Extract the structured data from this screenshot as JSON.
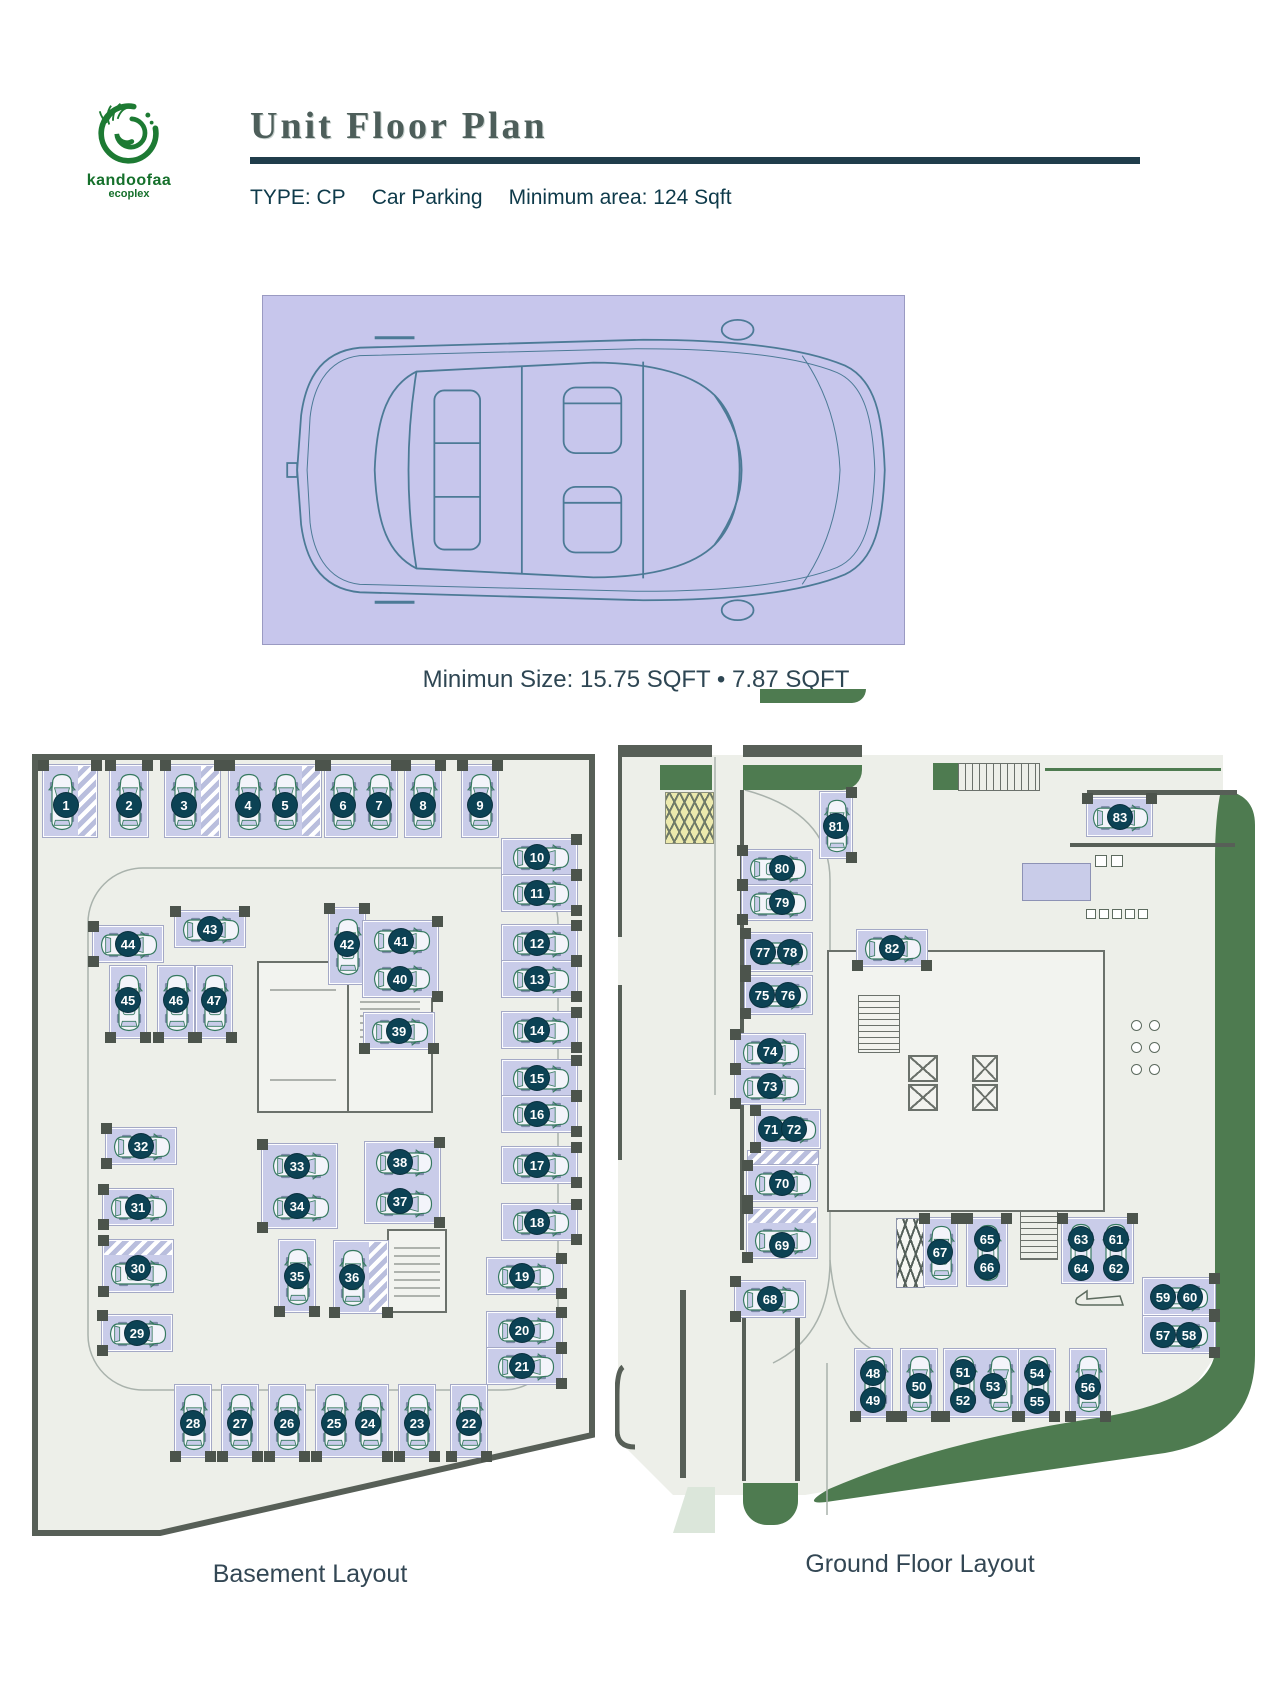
{
  "header": {
    "brand": "kandoofaa",
    "brand_sub": "ecoplex",
    "title": "Unit Floor Plan",
    "type_label": "TYPE: CP",
    "type_name": "Car Parking",
    "min_area": "Minimum area: 124 Sqft"
  },
  "spec": {
    "caption": "Minimun Size: 15.75 SQFT • 7.87 SQFT"
  },
  "colors": {
    "floor": "#edefe9",
    "wall": "#575f57",
    "stall": "#c9cce9",
    "circle": "#0c4254",
    "green": "#4e7b50",
    "logo-green": "#1d7a33",
    "rule": "#203d4b",
    "car-line": "#35795f",
    "spec-bg": "#c7c6ec",
    "yellow": "#ece9ad"
  },
  "plans": [
    {
      "id": "basement",
      "label": "Basement Layout",
      "outline": "5,57 562,57 562,735 130,833 5,833",
      "stalls": [
        {
          "x": 13,
          "y": 65,
          "w": 54,
          "h": 72,
          "dir": "v",
          "a": "t",
          "hatch": "r",
          "c": [
            [
              "1",
              36,
              105
            ]
          ]
        },
        {
          "x": 80,
          "y": 65,
          "w": 38,
          "h": 72,
          "dir": "v",
          "a": "t",
          "c": [
            [
              "2",
              99,
              105
            ]
          ]
        },
        {
          "x": 135,
          "y": 65,
          "w": 55,
          "h": 72,
          "dir": "v",
          "a": "t",
          "hatch": "r",
          "c": [
            [
              "3",
              154,
              105
            ]
          ]
        },
        {
          "x": 199,
          "y": 65,
          "w": 92,
          "h": 72,
          "dir": "v",
          "a": "t",
          "hatch": "r",
          "c": [
            [
              "4",
              218,
              105
            ],
            [
              "5",
              255,
              105
            ]
          ]
        },
        {
          "x": 295,
          "y": 65,
          "w": 72,
          "h": 72,
          "dir": "v",
          "a": "t",
          "c": [
            [
              "6",
              313,
              105
            ],
            [
              "7",
              349,
              105
            ]
          ]
        },
        {
          "x": 375,
          "y": 65,
          "w": 36,
          "h": 72,
          "dir": "v",
          "a": "t",
          "c": [
            [
              "8",
              393,
              105
            ]
          ]
        },
        {
          "x": 432,
          "y": 65,
          "w": 36,
          "h": 72,
          "dir": "v",
          "a": "t",
          "c": [
            [
              "9",
              450,
              105
            ]
          ]
        },
        {
          "x": 472,
          "y": 139,
          "w": 75,
          "h": 36,
          "dir": "h",
          "a": "r",
          "c": [
            [
              "10",
              507,
              157
            ]
          ]
        },
        {
          "x": 472,
          "y": 175,
          "w": 75,
          "h": 36,
          "dir": "h",
          "a": "r",
          "c": [
            [
              "11",
              507,
              193
            ]
          ]
        },
        {
          "x": 472,
          "y": 225,
          "w": 75,
          "h": 36,
          "dir": "h",
          "a": "r",
          "c": [
            [
              "12",
              507,
              243
            ]
          ]
        },
        {
          "x": 472,
          "y": 261,
          "w": 75,
          "h": 36,
          "dir": "h",
          "a": "r",
          "c": [
            [
              "13",
              507,
              279
            ]
          ]
        },
        {
          "x": 472,
          "y": 312,
          "w": 75,
          "h": 36,
          "dir": "h",
          "a": "r",
          "c": [
            [
              "14",
              507,
              330
            ]
          ]
        },
        {
          "x": 472,
          "y": 360,
          "w": 75,
          "h": 36,
          "dir": "h",
          "a": "r",
          "c": [
            [
              "15",
              507,
              378
            ]
          ]
        },
        {
          "x": 472,
          "y": 396,
          "w": 75,
          "h": 36,
          "dir": "h",
          "a": "r",
          "c": [
            [
              "16",
              507,
              414
            ]
          ]
        },
        {
          "x": 472,
          "y": 447,
          "w": 75,
          "h": 36,
          "dir": "h",
          "a": "r",
          "c": [
            [
              "17",
              507,
              465
            ]
          ]
        },
        {
          "x": 472,
          "y": 504,
          "w": 75,
          "h": 36,
          "dir": "h",
          "a": "r",
          "c": [
            [
              "18",
              507,
              522
            ]
          ]
        },
        {
          "x": 457,
          "y": 558,
          "w": 75,
          "h": 36,
          "dir": "h",
          "a": "r",
          "c": [
            [
              "19",
              492,
              576
            ]
          ]
        },
        {
          "x": 457,
          "y": 612,
          "w": 75,
          "h": 36,
          "dir": "h",
          "a": "r",
          "c": [
            [
              "20",
              492,
              630
            ]
          ]
        },
        {
          "x": 457,
          "y": 648,
          "w": 75,
          "h": 36,
          "dir": "h",
          "a": "r",
          "c": [
            [
              "21",
              492,
              666
            ]
          ]
        },
        {
          "x": 421,
          "y": 685,
          "w": 36,
          "h": 72,
          "dir": "v",
          "a": "b",
          "c": [
            [
              "22",
              439,
              723
            ]
          ]
        },
        {
          "x": 369,
          "y": 685,
          "w": 36,
          "h": 72,
          "dir": "v",
          "a": "b",
          "c": [
            [
              "23",
              387,
              723
            ]
          ]
        },
        {
          "x": 286,
          "y": 685,
          "w": 72,
          "h": 72,
          "dir": "v",
          "a": "b",
          "c": [
            [
              "25",
              304,
              723
            ],
            [
              "24",
              338,
              723
            ]
          ]
        },
        {
          "x": 239,
          "y": 685,
          "w": 36,
          "h": 72,
          "dir": "v",
          "a": "b",
          "c": [
            [
              "26",
              257,
              723
            ]
          ]
        },
        {
          "x": 192,
          "y": 685,
          "w": 36,
          "h": 72,
          "dir": "v",
          "a": "b",
          "c": [
            [
              "27",
              210,
              723
            ]
          ]
        },
        {
          "x": 145,
          "y": 685,
          "w": 36,
          "h": 72,
          "dir": "v",
          "a": "b",
          "c": [
            [
              "28",
              163,
              723
            ]
          ]
        },
        {
          "x": 72,
          "y": 615,
          "w": 70,
          "h": 36,
          "dir": "h",
          "a": "l",
          "c": [
            [
              "29",
              107,
              633
            ]
          ]
        },
        {
          "x": 73,
          "y": 540,
          "w": 70,
          "h": 52,
          "dir": "h",
          "a": "l",
          "hatch": "t",
          "c": [
            [
              "30",
              108,
              568
            ]
          ]
        },
        {
          "x": 73,
          "y": 489,
          "w": 70,
          "h": 36,
          "dir": "h",
          "a": "l",
          "c": [
            [
              "31",
              108,
              507
            ]
          ]
        },
        {
          "x": 76,
          "y": 428,
          "w": 70,
          "h": 36,
          "dir": "h",
          "a": "l",
          "c": [
            [
              "32",
              111,
              446
            ]
          ]
        },
        {
          "x": 63,
          "y": 226,
          "w": 70,
          "h": 36,
          "dir": "h",
          "a": "l",
          "c": [
            [
              "44",
              98,
              244
            ]
          ]
        },
        {
          "x": 145,
          "y": 211,
          "w": 70,
          "h": 36,
          "dir": "h",
          "a": "t",
          "c": [
            [
              "43",
              180,
              229
            ]
          ]
        },
        {
          "x": 80,
          "y": 266,
          "w": 36,
          "h": 72,
          "dir": "v",
          "a": "b",
          "c": [
            [
              "45",
              98,
              300
            ]
          ]
        },
        {
          "x": 128,
          "y": 266,
          "w": 36,
          "h": 72,
          "dir": "v",
          "a": "b",
          "c": [
            [
              "46",
              146,
              300
            ]
          ]
        },
        {
          "x": 166,
          "y": 266,
          "w": 36,
          "h": 72,
          "dir": "v",
          "a": "b",
          "c": [
            [
              "47",
              184,
              300
            ]
          ]
        },
        {
          "x": 299,
          "y": 208,
          "w": 36,
          "h": 76,
          "dir": "v",
          "a": "t",
          "c": [
            [
              "42",
              317,
              244
            ]
          ]
        },
        {
          "x": 333,
          "y": 221,
          "w": 75,
          "h": 76,
          "dir": "h",
          "a": "r",
          "c": [
            [
              "41",
              371,
              241
            ],
            [
              "40",
              370,
              279
            ]
          ]
        },
        {
          "x": 334,
          "y": 313,
          "w": 70,
          "h": 36,
          "dir": "h",
          "a": "b",
          "c": [
            [
              "39",
              369,
              331
            ]
          ]
        },
        {
          "x": 232,
          "y": 444,
          "w": 75,
          "h": 84,
          "dir": "h",
          "a": "l",
          "c": [
            [
              "33",
              267,
              466
            ],
            [
              "34",
              267,
              506
            ]
          ]
        },
        {
          "x": 335,
          "y": 442,
          "w": 75,
          "h": 81,
          "dir": "h",
          "a": "r",
          "c": [
            [
              "38",
              370,
              462
            ],
            [
              "37",
              370,
              501
            ]
          ]
        },
        {
          "x": 249,
          "y": 540,
          "w": 36,
          "h": 72,
          "dir": "v",
          "a": "b",
          "c": [
            [
              "35",
              267,
              576
            ]
          ]
        },
        {
          "x": 304,
          "y": 541,
          "w": 54,
          "h": 72,
          "dir": "v",
          "a": "b",
          "hatch": "r",
          "c": [
            [
              "36",
              322,
              577
            ]
          ]
        }
      ]
    },
    {
      "id": "ground",
      "label": "Ground Floor Layout",
      "stalls": [
        {
          "x": 205,
          "y": 97,
          "w": 32,
          "h": 66,
          "dir": "v",
          "a": "r",
          "c": [
            [
              "81",
              221,
              131
            ]
          ]
        },
        {
          "x": 127,
          "y": 155,
          "w": 70,
          "h": 35,
          "dir": "h",
          "a": "l",
          "c": [
            [
              "80",
              167,
              173
            ]
          ]
        },
        {
          "x": 127,
          "y": 190,
          "w": 70,
          "h": 35,
          "dir": "h",
          "a": "l",
          "c": [
            [
              "79",
              167,
              207
            ]
          ]
        },
        {
          "x": 130,
          "y": 238,
          "w": 67,
          "h": 38,
          "dir": "h",
          "a": "l",
          "c": [
            [
              "77",
              148,
              257
            ],
            [
              "78",
              175,
              257
            ]
          ]
        },
        {
          "x": 130,
          "y": 281,
          "w": 67,
          "h": 38,
          "dir": "h",
          "a": "l",
          "c": [
            [
              "75",
              147,
              300
            ],
            [
              "76",
              173,
              300
            ]
          ]
        },
        {
          "x": 120,
          "y": 339,
          "w": 70,
          "h": 35,
          "dir": "h",
          "a": "l",
          "c": [
            [
              "74",
              155,
              356
            ]
          ]
        },
        {
          "x": 120,
          "y": 374,
          "w": 70,
          "h": 35,
          "dir": "h",
          "a": "l",
          "c": [
            [
              "73",
              155,
              391
            ]
          ]
        },
        {
          "x": 140,
          "y": 415,
          "w": 65,
          "h": 38,
          "dir": "h",
          "a": "l",
          "c": [
            [
              "71",
              156,
              434
            ],
            [
              "72",
              179,
              434
            ]
          ]
        },
        {
          "x": 132,
          "y": 470,
          "w": 70,
          "h": 36,
          "dir": "h",
          "a": "l",
          "c": [
            [
              "70",
              167,
              488
            ]
          ]
        },
        {
          "x": 132,
          "y": 513,
          "w": 70,
          "h": 50,
          "dir": "h",
          "a": "l",
          "hatch": "t",
          "c": [
            [
              "69",
              167,
              550
            ]
          ]
        },
        {
          "x": 120,
          "y": 586,
          "w": 70,
          "h": 36,
          "dir": "h",
          "a": "l",
          "c": [
            [
              "68",
              155,
              604
            ]
          ]
        },
        {
          "x": 242,
          "y": 235,
          "w": 70,
          "h": 36,
          "dir": "h",
          "a": "b",
          "c": [
            [
              "82",
              277,
              253
            ]
          ]
        },
        {
          "x": 472,
          "y": 103,
          "w": 65,
          "h": 38,
          "dir": "h",
          "a": "t",
          "c": [
            [
              "83",
              505,
              122
            ]
          ]
        },
        {
          "x": 309,
          "y": 523,
          "w": 33,
          "h": 68,
          "dir": "v",
          "a": "t",
          "c": [
            [
              "67",
              325,
              557
            ]
          ]
        },
        {
          "x": 352,
          "y": 523,
          "w": 40,
          "h": 68,
          "dir": "v",
          "a": "t",
          "c": [
            [
              "65",
              372,
              544
            ],
            [
              "66",
              372,
              572
            ]
          ]
        },
        {
          "x": 447,
          "y": 523,
          "w": 71,
          "h": 65,
          "dir": "v",
          "a": "t",
          "c": [
            [
              "63",
              466,
              544
            ],
            [
              "64",
              466,
              573
            ],
            [
              "61",
              501,
              544
            ],
            [
              "62",
              501,
              573
            ]
          ]
        },
        {
          "x": 528,
          "y": 583,
          "w": 72,
          "h": 37,
          "dir": "h",
          "a": "r",
          "c": [
            [
              "59",
              548,
              602
            ],
            [
              "60",
              575,
              602
            ]
          ]
        },
        {
          "x": 528,
          "y": 621,
          "w": 72,
          "h": 37,
          "dir": "h",
          "a": "r",
          "c": [
            [
              "57",
              548,
              640
            ],
            [
              "58",
              574,
              640
            ]
          ]
        },
        {
          "x": 240,
          "y": 654,
          "w": 37,
          "h": 68,
          "dir": "v",
          "a": "b",
          "c": [
            [
              "48",
              258,
              678
            ],
            [
              "49",
              258,
              705
            ]
          ]
        },
        {
          "x": 286,
          "y": 654,
          "w": 36,
          "h": 68,
          "dir": "v",
          "a": "b",
          "c": [
            [
              "50",
              304,
              691
            ]
          ]
        },
        {
          "x": 329,
          "y": 654,
          "w": 74,
          "h": 68,
          "dir": "v",
          "a": "b",
          "c": [
            [
              "51",
              348,
              677
            ],
            [
              "52",
              348,
              705
            ],
            [
              "53",
              378,
              691
            ]
          ]
        },
        {
          "x": 404,
          "y": 654,
          "w": 36,
          "h": 68,
          "dir": "v",
          "a": "b",
          "c": [
            [
              "54",
              422,
              678
            ],
            [
              "55",
              422,
              706
            ]
          ]
        },
        {
          "x": 455,
          "y": 654,
          "w": 36,
          "h": 68,
          "dir": "v",
          "a": "b",
          "c": [
            [
              "56",
              473,
              692
            ]
          ]
        }
      ]
    }
  ]
}
